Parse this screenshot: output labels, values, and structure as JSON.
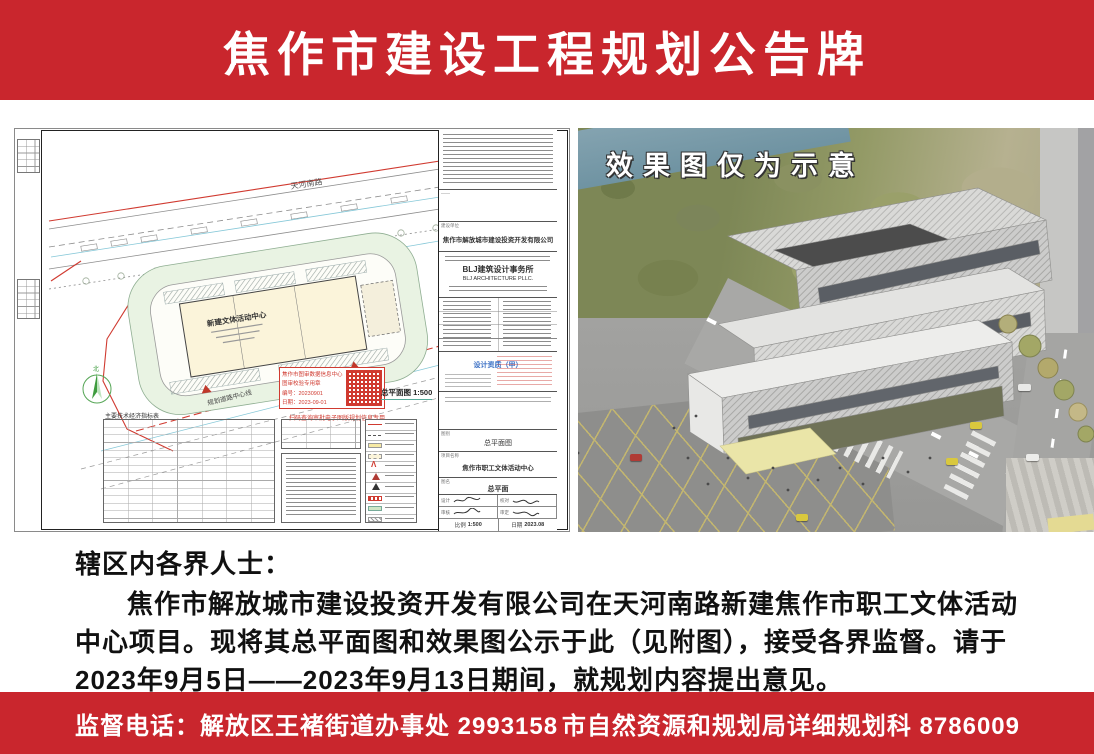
{
  "header": {
    "title": "焦作市建设工程规划公告牌"
  },
  "notice": {
    "salutation": "辖区内各界人士：",
    "body": "焦作市解放城市建设投资开发有限公司在天河南路新建焦作市职工文体活动中心项目。现将其总平面图和效果图公示于此（见附图），接受各界监督。请于2023年9月5日——2023年9月13日期间，就规划内容提出意见。"
  },
  "footer": {
    "left": "监督电话：解放区王褚街道办事处  2993158",
    "right": "市自然资源和规划局详细规划科  8786009"
  },
  "site_plan": {
    "road_label": "天河南路",
    "road_label_bottom": "规划道路中心线",
    "building_label": "新建文体活动中心",
    "scale_label": "总平面图  1:500",
    "compass_label": "北",
    "table_title": "主要技术经济指标表",
    "stamp": {
      "line1": "焦作市图审数据信息中心",
      "line2": "图审校验专用章",
      "line3": "编号：20230901",
      "line4": "日期：2023-09-01",
      "caption": "扫码查询审批电子图版规划信息专用"
    },
    "titleblock": {
      "client_label": "建设单位",
      "client": "焦作市解放城市建设投资开发有限公司",
      "firm_cn": "BLJ建筑设计事务所",
      "firm_en": "BLJ ARCHITECTURE PLLC.",
      "qualification": "设计资质（甲）",
      "sheet_type_label": "图别",
      "sheet_type": "总平面图",
      "project_label": "项目名称",
      "project": "焦作市职工文体活动中心",
      "drawing_label": "图名",
      "drawing": "总平面",
      "sig_labels": [
        "设计",
        "校对",
        "审核",
        "审定"
      ],
      "scale_label": "比例",
      "scale": "1:500",
      "date_label": "日期",
      "date": "2023.08"
    }
  },
  "rendering": {
    "caption": "效果图仅为示意"
  }
}
